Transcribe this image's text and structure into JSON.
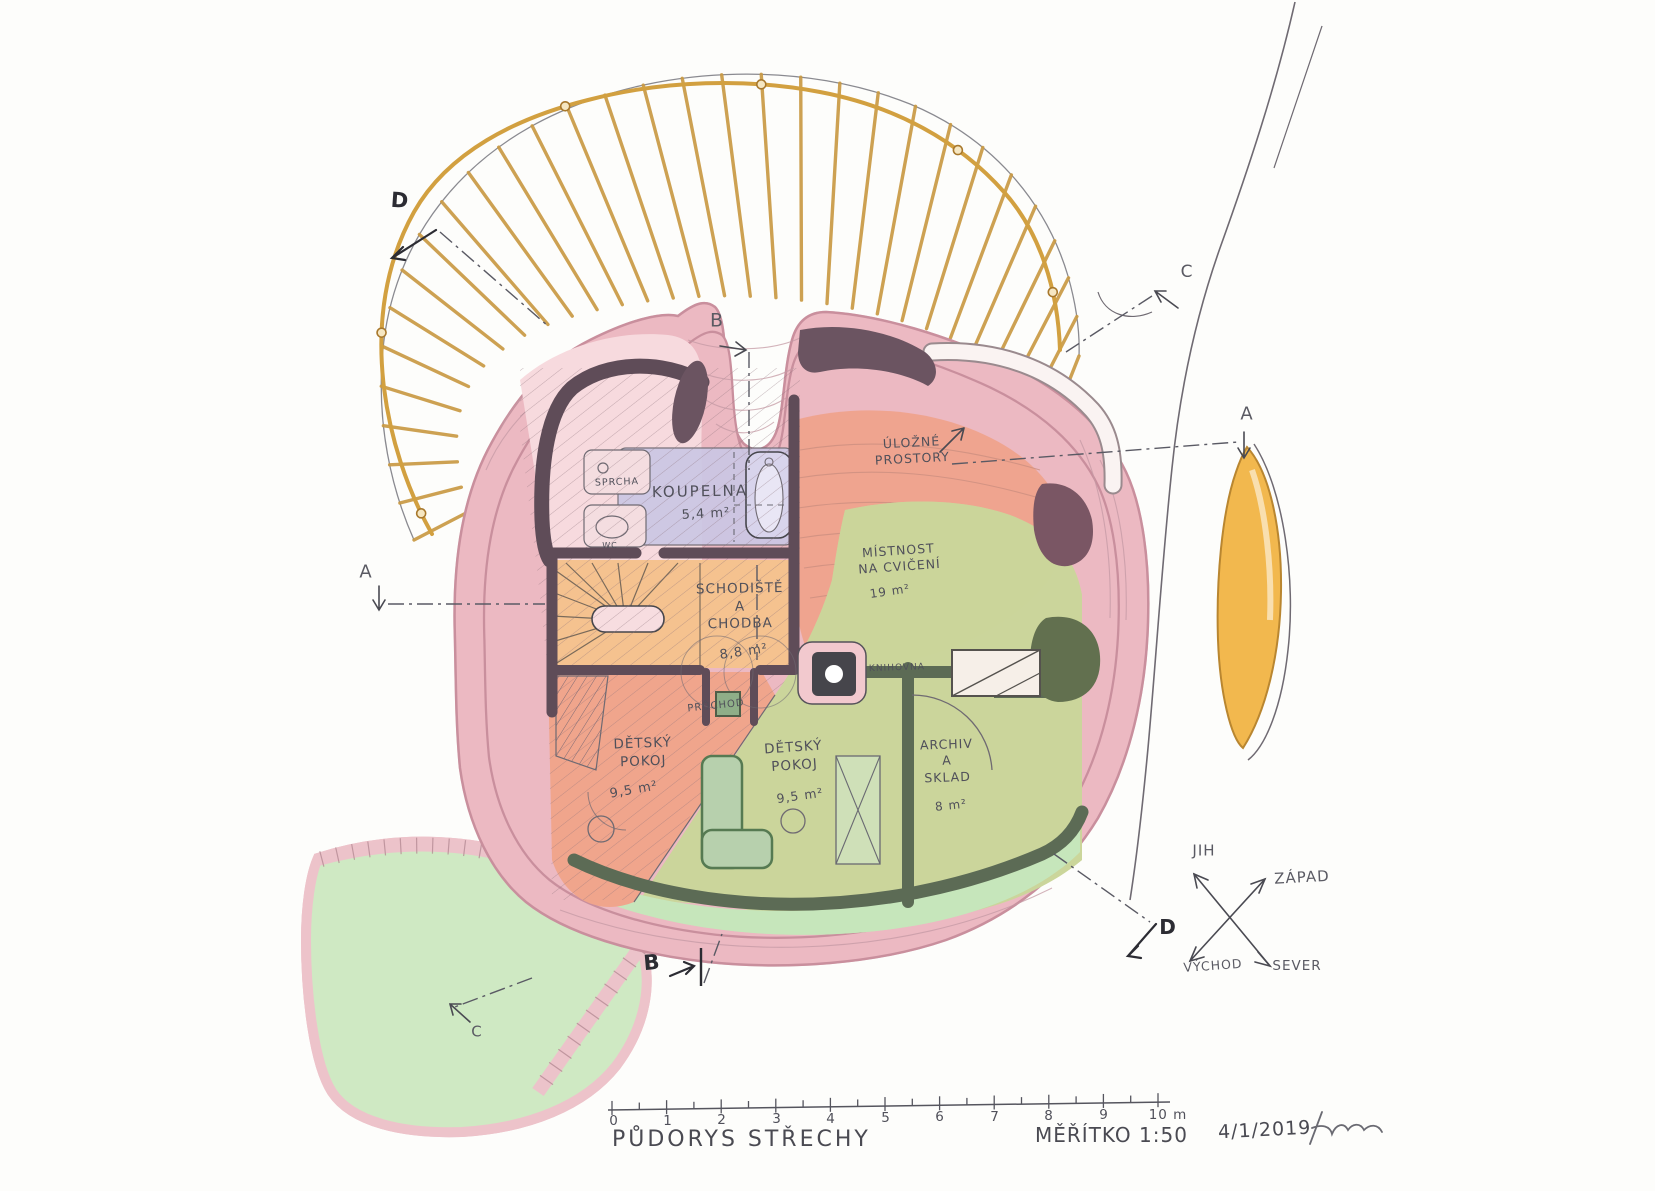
{
  "title_block": {
    "title": "PŮDORYS STŘECHY",
    "scale": "MĚŘÍTKO 1:50",
    "date": "4/1/2019"
  },
  "scale_bar": {
    "tick_labels": [
      "0",
      "1",
      "2",
      "3",
      "4",
      "5",
      "6",
      "7",
      "8",
      "9",
      "10 m"
    ]
  },
  "compass": {
    "south": "JIH",
    "west": "ZÁPAD",
    "east": "VÝCHOD",
    "north": "SEVER"
  },
  "sections": {
    "a": "A",
    "b": "B",
    "c": "C",
    "d": "D"
  },
  "rooms": {
    "koupelna": {
      "name": "KOUPELNA",
      "area": "5,4 m²"
    },
    "sprcha": {
      "name": "SPRCHA"
    },
    "wc": {
      "name": "WC"
    },
    "schodiste": {
      "name": "SCHODIŠTĚ\nA\nCHODBA",
      "area": "8,8 m²"
    },
    "ulozne": {
      "name": "ÚLOŽNÉ\nPROSTORY"
    },
    "cvicebna": {
      "name": "MÍSTNOST\nNA CVIČENÍ",
      "area": "19 m²"
    },
    "knihovna": {
      "name": "KNIHOVNA"
    },
    "pruchod": {
      "name": "PRŮCHOD"
    },
    "detsky1": {
      "name": "DĚTSKÝ\nPOKOJ",
      "area": "9,5 m²"
    },
    "detsky2": {
      "name": "DĚTSKÝ\nPOKOJ",
      "area": "9,5 m²"
    },
    "archiv": {
      "name": "ARCHIV\nA\nSKLAD",
      "area": "8 m²"
    }
  },
  "palette": {
    "roof_pink": "#ecb9c2",
    "interior_pink": "#f6d6da",
    "rafter_gold": "#c99a44",
    "stairs_orange": "#f5c28f",
    "room_salmon": "#efa28a",
    "bathroom_lavender": "#cbc7e4",
    "green_olive": "#cbd69b",
    "green_light": "#cfe9c3",
    "wall_dark": "#5f4c58"
  }
}
